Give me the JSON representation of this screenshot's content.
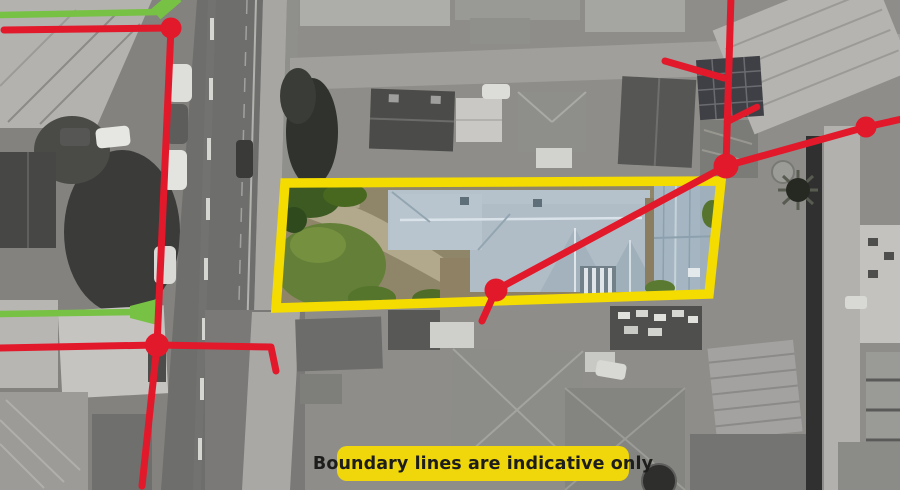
{
  "banner": {
    "text": "Boundary lines are indicative only"
  },
  "colors": {
    "boundary": "#F4DB00",
    "red_line": "#E2192B",
    "green_line": "#77C144",
    "banner_bg": "#F0D70C",
    "banner_text": "#1D1D1B"
  }
}
